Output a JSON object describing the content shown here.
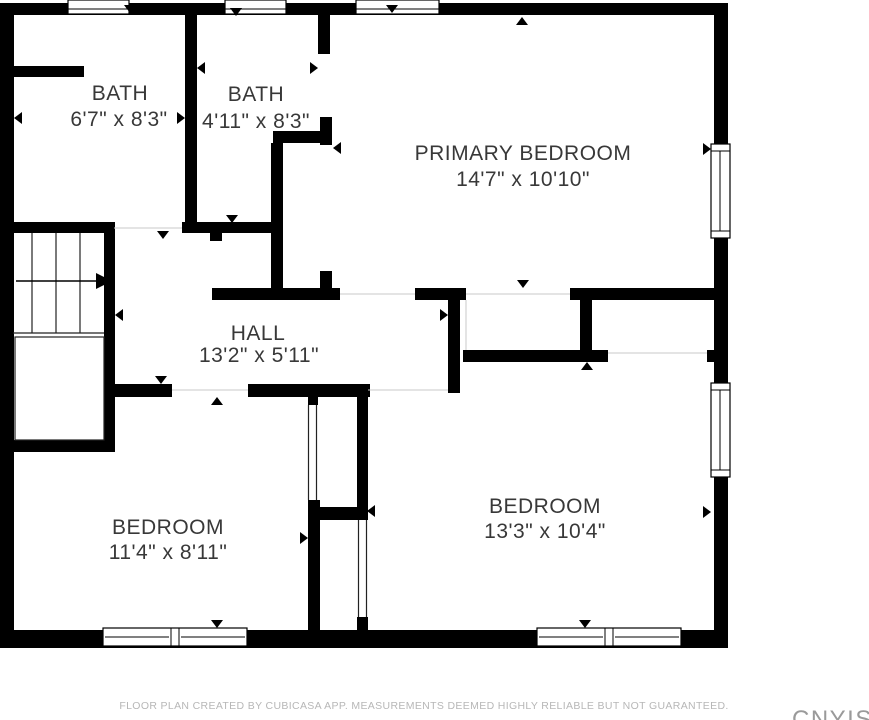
{
  "rooms": {
    "bath1": {
      "name": "BATH",
      "dimensions": "6'7\" x 8'3\""
    },
    "bath2": {
      "name": "BATH",
      "dimensions": "4'11\" x 8'3\""
    },
    "primary_bedroom": {
      "name": "PRIMARY BEDROOM",
      "dimensions": "14'7\" x 10'10\""
    },
    "hall": {
      "name": "HALL",
      "dimensions": "13'2\" x 5'11\""
    },
    "bedroom_left": {
      "name": "BEDROOM",
      "dimensions": "11'4\" x 8'11\""
    },
    "bedroom_right": {
      "name": "BEDROOM",
      "dimensions": "13'3\" x 10'4\""
    }
  },
  "footer": {
    "disclaimer": "FLOOR PLAN CREATED BY CUBICASA APP. MEASUREMENTS DEEMED HIGHLY RELIABLE BUT NOT GUARANTEED."
  },
  "watermark": {
    "text": "CNYIS"
  },
  "colors": {
    "wall": "#000000",
    "label": "#383838",
    "footer_text": "#b7b7b7",
    "watermark": "#9a9a9a",
    "background": "#ffffff"
  }
}
